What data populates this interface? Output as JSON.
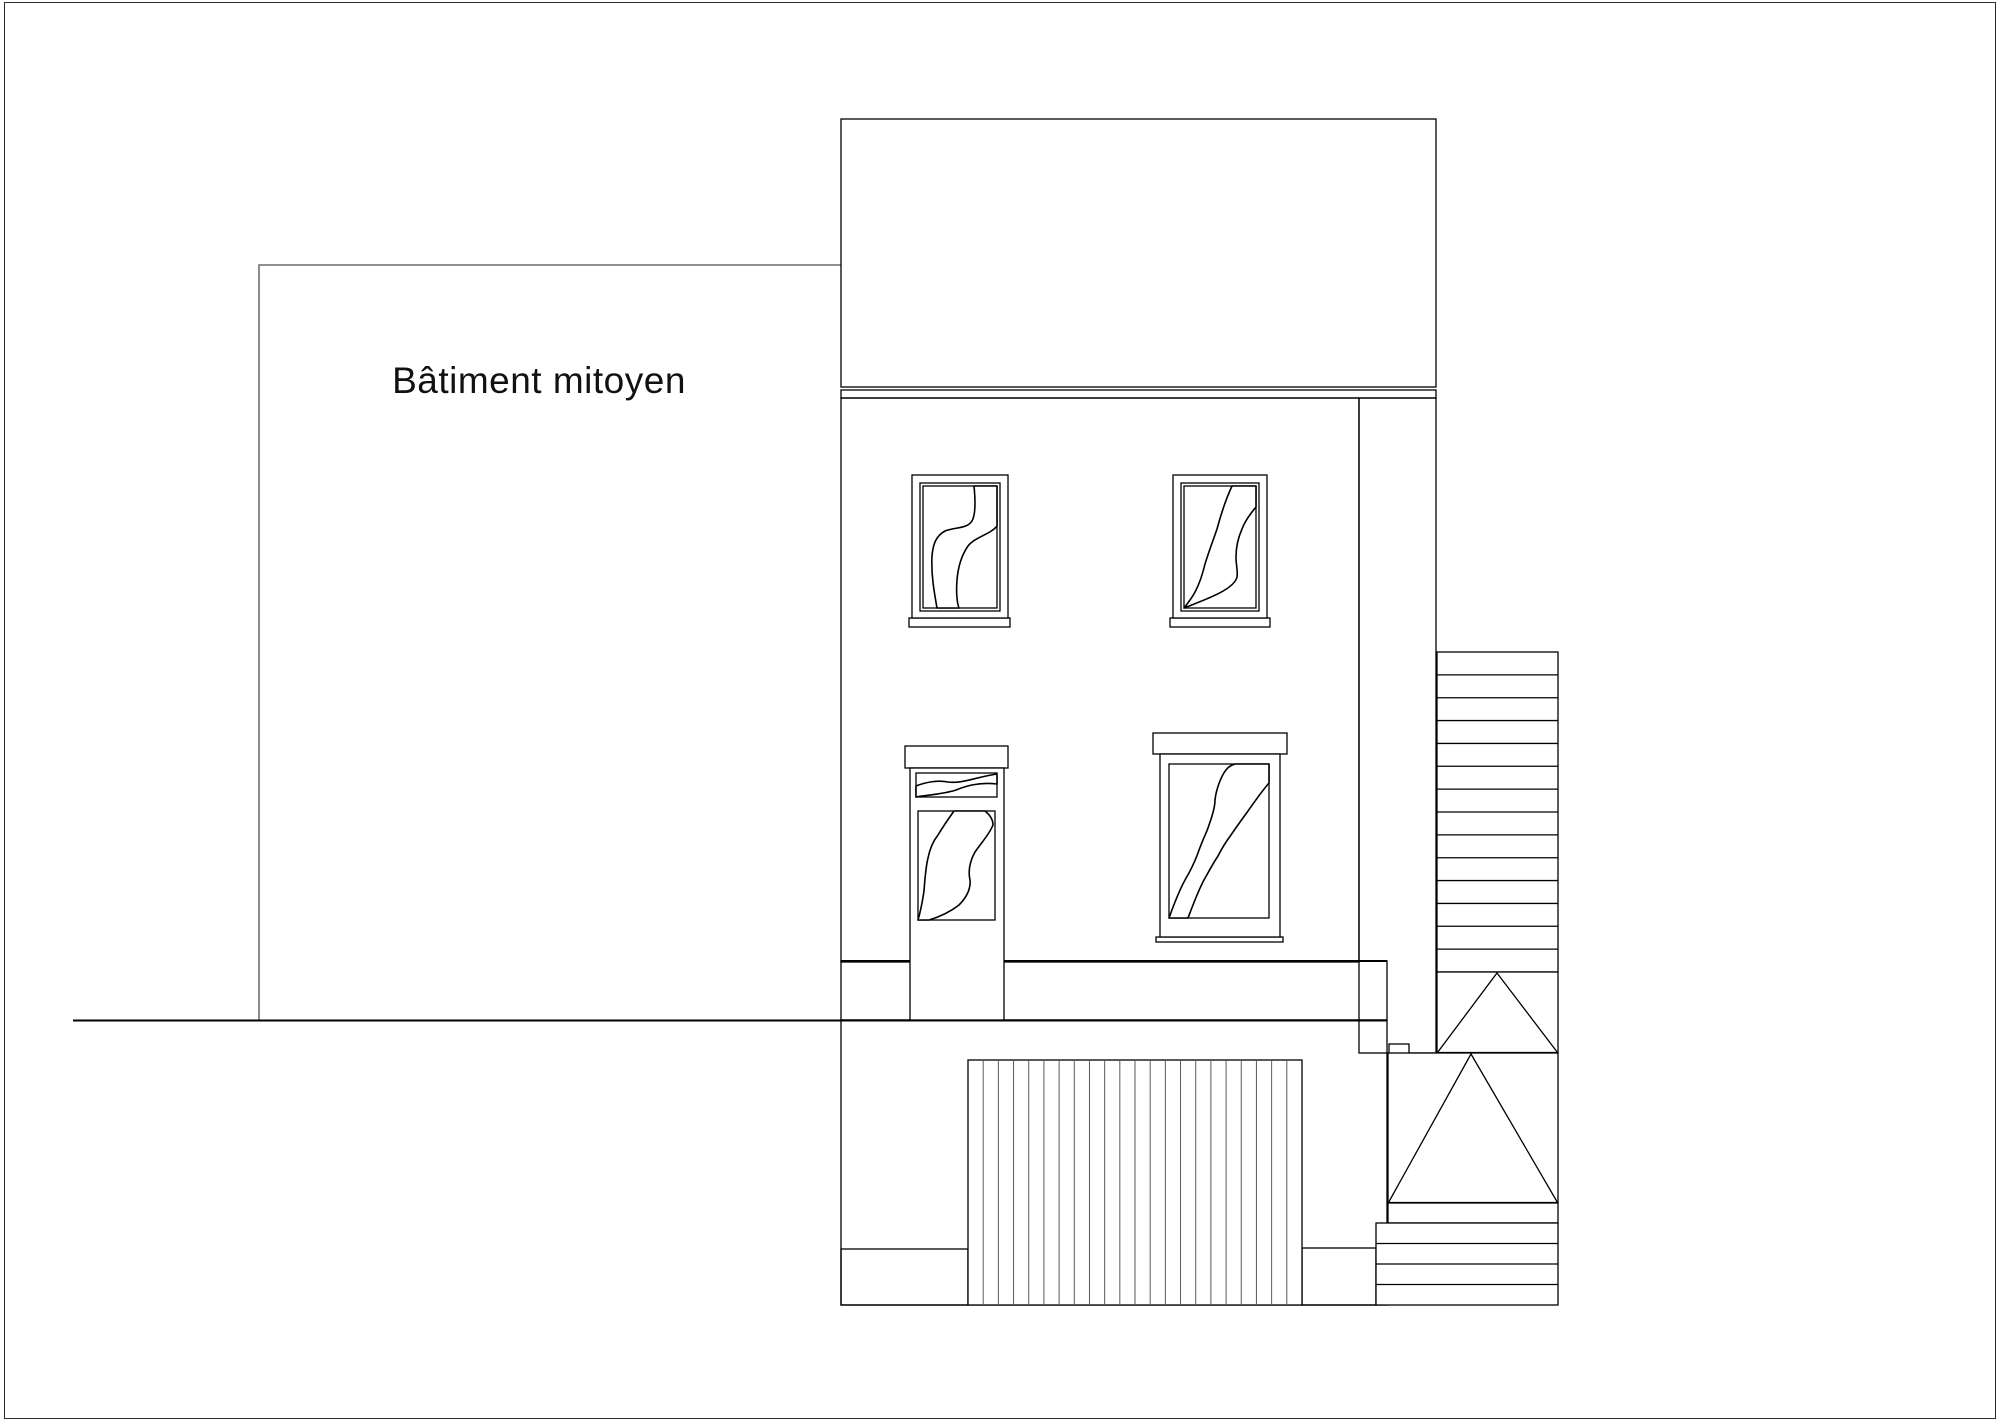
{
  "page": {
    "adjoining_label": "Bâtiment mitoyen"
  },
  "colors": {
    "line": "#000000",
    "secondary_line": "#808080",
    "page_border": "#2b2b2b",
    "glass": "#c7c7c7",
    "pattern": "#b4b4b4",
    "hatch": "#c9c9c9",
    "cobble": "#a8a8a8",
    "cobble_dark": "#7d7d7d",
    "slat": "#5a5a5a",
    "text": "#111111"
  },
  "counts": {
    "stair_steps": 14,
    "garage_slats": 21,
    "lower_steps": 4
  }
}
